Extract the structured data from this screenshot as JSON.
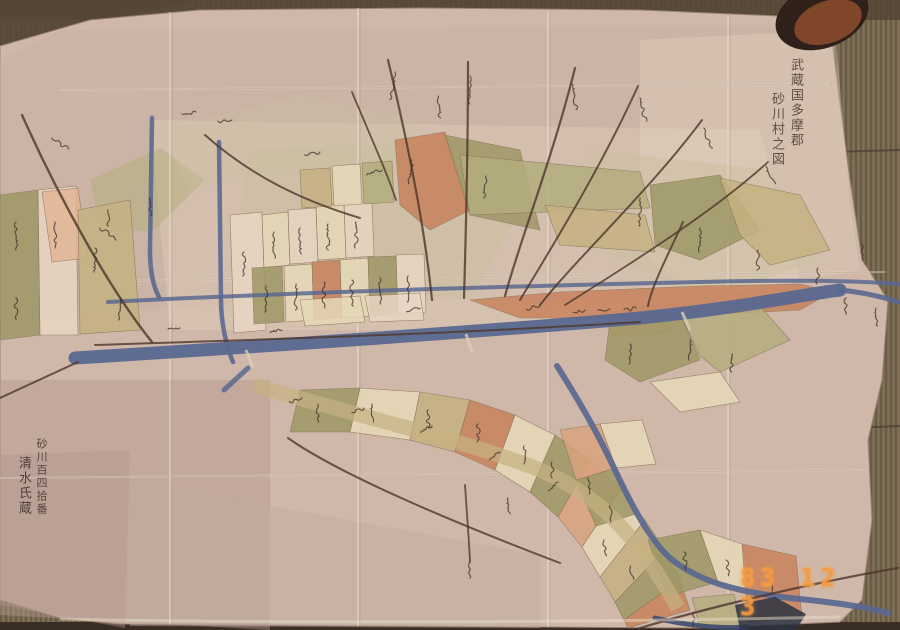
{
  "photo": {
    "date_stamp": {
      "text": "83 12 3",
      "color": "#f49b43"
    }
  },
  "map": {
    "title_columns": {
      "col1": "武蔵国多摩郡",
      "col2": "砂川村之図"
    },
    "owner_columns": {
      "col1": "砂川百四拾番",
      "col2": "清水氏蔵"
    }
  },
  "palette": {
    "paper": "#cfb8a9",
    "paperLight": "#ddc9b6",
    "paperGray": "#c2aba0",
    "paperMauve": "#b1978b",
    "tatami": "#796a51",
    "tatamiDark": "#554737",
    "olive": "#9e9866",
    "oliveLight": "#b4ae7e",
    "khaki": "#c6b282",
    "cream": "#e6d9b8",
    "creamPink": "#e9d6c4",
    "salmon": "#c8835d",
    "salmonLight": "#d9a37e",
    "peach": "#e2b595",
    "wash": "#c9c0a0",
    "river": "#5a6890",
    "riverDark": "#3e4a6e",
    "road": "#4e362b",
    "ink": "#3e302a",
    "crease": "#ece0d0",
    "weight": "#8a4a2c",
    "weightDark": "#30201a"
  },
  "geometry": {
    "paper_outline": "0,46 90,20 200,10 420,8 640,10 778,16 830,26 838,90 850,180 862,260 888,300 882,380 868,440 872,520 862,600 840,622 700,628 400,626 120,624 60,618 0,600",
    "tone_patches": [
      {
        "points": "60,30 830,26 845,150 860,270 700,300 400,300 100,310 0,320 0,60",
        "color": "paperGray",
        "op": 0.35
      },
      {
        "points": "150,120 760,130 800,280 500,330 170,330",
        "color": "paperLight",
        "op": 0.5
      },
      {
        "points": "0,380 270,380 270,630 0,615",
        "color": "paperMauve",
        "op": 0.45
      },
      {
        "points": "0,455 130,450 125,628 0,605",
        "color": "paperMauve",
        "op": 0.4
      },
      {
        "points": "130,480 540,555 540,628 130,626",
        "color": "paperGray",
        "op": 0.45
      },
      {
        "points": "640,40 835,30 850,200 860,270 700,300 640,250",
        "color": "creamPink",
        "op": 0.35
      }
    ],
    "washes": [
      {
        "points": "250,150 470,140 520,210 470,300 300,280 240,210",
        "color": "wash",
        "op": 0.55
      },
      {
        "points": "590,150 770,170 820,260 700,300 600,250",
        "color": "wash",
        "op": 0.5
      },
      {
        "points": "90,180 160,148 205,180 152,232 100,226",
        "color": "oliveLight",
        "op": 0.55
      },
      {
        "points": "160,130 300,95 420,120 400,160 250,175 190,190",
        "color": "wash",
        "op": 0.35
      }
    ],
    "parcels": [
      {
        "points": "0,195 38,190 40,335 0,340",
        "color": "olive"
      },
      {
        "points": "38,190 76,186 78,335 40,335",
        "color": "creamPink"
      },
      {
        "points": "42,192 78,188 88,258 52,262",
        "color": "peach"
      },
      {
        "points": "78,210 130,200 140,330 80,334",
        "color": "khaki"
      },
      {
        "points": "230,215 262,212 266,330 234,333",
        "color": "creamPink"
      },
      {
        "points": "262,215 288,212 290,265 264,268",
        "color": "cream"
      },
      {
        "points": "288,210 316,208 318,262 290,264",
        "color": "creamPink"
      },
      {
        "points": "316,206 344,204 346,258 318,260",
        "color": "cream"
      },
      {
        "points": "344,204 372,202 374,256 346,258",
        "color": "creamPink"
      },
      {
        "points": "252,268 282,266 284,322 254,324",
        "color": "olive"
      },
      {
        "points": "284,266 312,264 314,320 286,322",
        "color": "cream"
      },
      {
        "points": "312,262 340,260 342,318 314,320",
        "color": "salmon"
      },
      {
        "points": "340,260 368,258 370,316 342,318",
        "color": "cream"
      },
      {
        "points": "368,257 396,256 398,314 370,316",
        "color": "olive"
      },
      {
        "points": "396,255 424,254 426,312 398,314",
        "color": "creamPink"
      },
      {
        "points": "300,170 330,168 332,206 302,208",
        "color": "khaki"
      },
      {
        "points": "332,166 360,164 362,204 334,206",
        "color": "cream"
      },
      {
        "points": "362,163 392,161 394,202 364,204",
        "color": "oliveLight"
      },
      {
        "points": "395,140 445,132 470,210 430,230 400,205",
        "color": "salmon"
      },
      {
        "points": "445,135 520,150 540,230 470,215",
        "color": "olive"
      },
      {
        "points": "460,155 640,172 650,208 470,215",
        "color": "oliveLight"
      },
      {
        "points": "545,205 645,215 655,252 560,245",
        "color": "khaki"
      },
      {
        "points": "650,185 720,175 760,230 700,260 655,245",
        "color": "olive"
      },
      {
        "points": "720,178 800,195 830,250 770,265 740,235",
        "color": "khaki"
      },
      {
        "points": "470,300 560,292 700,286 800,284 832,292 800,310 640,318 520,318",
        "color": "salmon"
      },
      {
        "points": "300,300 360,296 365,322 305,326",
        "color": "cream"
      },
      {
        "points": "365,296 420,293 424,320 370,322",
        "color": "creamPink"
      },
      {
        "points": "608,318 668,314 672,332 612,336",
        "color": "salmonLight"
      },
      {
        "points": "610,320 680,314 700,360 640,382 605,360",
        "color": "olive"
      },
      {
        "points": "680,314 760,306 790,340 720,372 700,356",
        "color": "oliveLight"
      },
      {
        "points": "650,382 720,372 740,402 680,412",
        "color": "cream"
      },
      {
        "points": "300,390 360,388 350,432 290,432",
        "color": "olive"
      },
      {
        "points": "360,388 420,392 410,440 350,432",
        "color": "cream"
      },
      {
        "points": "420,392 470,400 455,452 410,440",
        "color": "khaki"
      },
      {
        "points": "470,400 515,415 495,470 455,452",
        "color": "salmon"
      },
      {
        "points": "515,415 555,435 530,492 495,470",
        "color": "cream"
      },
      {
        "points": "555,435 590,460 558,517 530,492",
        "color": "olive"
      },
      {
        "points": "590,460 620,490 582,547 558,517",
        "color": "salmonLight"
      },
      {
        "points": "620,490 645,520 600,577 582,547",
        "color": "cream"
      },
      {
        "points": "645,520 665,550 615,602 600,577",
        "color": "khaki"
      },
      {
        "points": "665,550 680,580 624,620 615,602",
        "color": "olive"
      },
      {
        "points": "680,580 690,610 628,628 624,620",
        "color": "salmon"
      },
      {
        "points": "560,430 600,424 616,468 576,480",
        "color": "salmonLight"
      },
      {
        "points": "600,424 642,420 656,464 616,468",
        "color": "cream"
      },
      {
        "points": "576,480 616,468 636,514 596,526",
        "color": "olive"
      },
      {
        "points": "648,540 700,530 718,582 668,596",
        "color": "olive"
      },
      {
        "points": "700,530 742,544 754,592 718,582",
        "color": "cream"
      },
      {
        "points": "742,544 796,556 802,618 748,622",
        "color": "salmon"
      },
      {
        "points": "692,598 734,594 742,628 700,628",
        "color": "oliveLight"
      }
    ],
    "valley_edge": {
      "d": "M255,385 C 340,412 460,438 540,470 C 600,495 640,540 678,608",
      "color": "khaki",
      "w": 15,
      "op": 0.7
    },
    "creases": [
      {
        "d": "M170,12 L170,624",
        "v": true
      },
      {
        "d": "M358,8 L358,626",
        "v": true
      },
      {
        "d": "M548,11 L548,627",
        "v": true
      },
      {
        "d": "M728,16 L728,627",
        "v": true
      },
      {
        "d": "M60,90 L830,84",
        "v": false
      },
      {
        "d": "M0,282 L885,272",
        "v": false
      },
      {
        "d": "M0,478 L868,470",
        "v": false
      }
    ],
    "rivers": [
      {
        "d": "M75,358 C 300,344 500,330 640,318 C 740,308 800,295 840,290",
        "w": 13,
        "op": 0.95,
        "color": "river"
      },
      {
        "d": "M840,290 C 860,292 880,296 898,302",
        "w": 5,
        "op": 0.9,
        "color": "river"
      },
      {
        "d": "M108,302 C 300,292 520,286 700,282 C 780,280 850,280 898,284",
        "w": 4,
        "op": 0.85,
        "color": "river"
      },
      {
        "d": "M152,118 L150,250 C 150,272 153,286 159,297",
        "w": 4.5,
        "op": 0.9,
        "color": "river"
      },
      {
        "d": "M219,142 L221,300 C 221,322 226,346 233,362",
        "w": 4.5,
        "op": 0.9,
        "color": "river"
      },
      {
        "d": "M248,368 L224,390",
        "w": 5,
        "op": 0.85,
        "color": "river"
      },
      {
        "d": "M557,366 C 580,402 601,440 615,470 C 632,506 650,540 670,558 C 700,583 740,592 790,598 C 830,602 862,606 888,613",
        "w": 6,
        "op": 0.92,
        "color": "river"
      },
      {
        "d": "M655,618 C 690,626 720,629 748,627",
        "w": 5,
        "op": 0.9,
        "color": "riverDark"
      }
    ],
    "bridges": [
      {
        "d": "M246,350 L253,368"
      },
      {
        "d": "M466,334 L472,352"
      },
      {
        "d": "M682,312 L690,330"
      }
    ],
    "roads": [
      {
        "d": "M388,60 C 412,160 426,240 432,300",
        "w": 2.2
      },
      {
        "d": "M468,62 C 468,150 466,230 464,298",
        "w": 2.2
      },
      {
        "d": "M575,68 C 552,160 520,240 505,296",
        "w": 2.2
      },
      {
        "d": "M638,86 C 600,170 550,250 520,300",
        "w": 2
      },
      {
        "d": "M702,120 C 650,190 575,260 540,305",
        "w": 2
      },
      {
        "d": "M768,162 C 710,215 620,270 565,305",
        "w": 1.8
      },
      {
        "d": "M205,135 C 250,175 300,200 360,218",
        "w": 2
      },
      {
        "d": "M22,115 C 60,200 110,290 152,342",
        "w": 2.4
      },
      {
        "d": "M95,345 C 250,340 450,334 640,322",
        "w": 2
      },
      {
        "d": "M683,222 C 668,255 652,285 648,306",
        "w": 2
      },
      {
        "d": "M78,362 L0,398",
        "w": 2
      },
      {
        "d": "M288,438 C 340,475 460,525 560,563",
        "w": 2
      },
      {
        "d": "M465,485 C 467,515 469,540 470,562",
        "w": 1.8
      },
      {
        "d": "M640,628 C 700,610 800,585 898,568",
        "w": 2.2
      },
      {
        "d": "M352,92 C 372,140 388,175 396,200",
        "w": 1.8
      }
    ],
    "marks": [
      [
        395,
        72,
        28,
        8
      ],
      [
        470,
        76,
        28,
        0
      ],
      [
        572,
        84,
        26,
        -10
      ],
      [
        640,
        98,
        24,
        -14
      ],
      [
        704,
        128,
        22,
        -20
      ],
      [
        766,
        166,
        20,
        -24
      ],
      [
        52,
        138,
        20,
        -55
      ],
      [
        100,
        228,
        20,
        -55
      ],
      [
        196,
        112,
        14,
        80
      ],
      [
        232,
        120,
        14,
        80
      ],
      [
        320,
        152,
        16,
        76
      ],
      [
        382,
        170,
        16,
        74
      ],
      [
        438,
        96,
        22,
        -4
      ],
      [
        640,
        198,
        28,
        0
      ],
      [
        700,
        228,
        24,
        0
      ],
      [
        758,
        250,
        20,
        0
      ],
      [
        818,
        268,
        16,
        0
      ],
      [
        16,
        222,
        28,
        0
      ],
      [
        55,
        222,
        26,
        0
      ],
      [
        16,
        298,
        22,
        0
      ],
      [
        95,
        248,
        24,
        0
      ],
      [
        120,
        298,
        22,
        0
      ],
      [
        274,
        232,
        26,
        0
      ],
      [
        300,
        228,
        26,
        0
      ],
      [
        328,
        224,
        26,
        0
      ],
      [
        356,
        222,
        26,
        0
      ],
      [
        266,
        286,
        26,
        0
      ],
      [
        296,
        284,
        26,
        0
      ],
      [
        324,
        282,
        26,
        0
      ],
      [
        352,
        280,
        26,
        0
      ],
      [
        380,
        278,
        26,
        0
      ],
      [
        408,
        276,
        26,
        0
      ],
      [
        244,
        252,
        24,
        0
      ],
      [
        412,
        160,
        24,
        6
      ],
      [
        486,
        176,
        22,
        4
      ],
      [
        180,
        328,
        12,
        80
      ],
      [
        282,
        330,
        12,
        80
      ],
      [
        420,
        308,
        14,
        80
      ],
      [
        540,
        306,
        14,
        80
      ],
      [
        585,
        310,
        12,
        78
      ],
      [
        610,
        309,
        12,
        78
      ],
      [
        636,
        308,
        12,
        78
      ],
      [
        846,
        298,
        16,
        0
      ],
      [
        876,
        308,
        18,
        0
      ],
      [
        862,
        244,
        16,
        0
      ],
      [
        630,
        344,
        20,
        0
      ],
      [
        690,
        340,
        20,
        0
      ],
      [
        732,
        354,
        18,
        0
      ],
      [
        318,
        404,
        18,
        0
      ],
      [
        372,
        404,
        18,
        0
      ],
      [
        428,
        410,
        18,
        0
      ],
      [
        478,
        424,
        18,
        0
      ],
      [
        524,
        446,
        18,
        -6
      ],
      [
        302,
        398,
        13,
        68
      ],
      [
        364,
        408,
        13,
        66
      ],
      [
        432,
        426,
        13,
        62
      ],
      [
        500,
        452,
        13,
        58
      ],
      [
        558,
        482,
        13,
        52
      ],
      [
        588,
        478,
        16,
        -6
      ],
      [
        610,
        506,
        16,
        -8
      ],
      [
        552,
        462,
        16,
        -4
      ],
      [
        604,
        540,
        16,
        -8
      ],
      [
        630,
        566,
        14,
        -10
      ],
      [
        684,
        552,
        18,
        -6
      ],
      [
        726,
        560,
        16,
        -10
      ],
      [
        770,
        578,
        16,
        -12
      ],
      [
        694,
        612,
        14,
        0
      ],
      [
        470,
        562,
        16,
        0
      ],
      [
        508,
        498,
        16,
        -4
      ],
      [
        150,
        198,
        18,
        0
      ],
      [
        108,
        210,
        16,
        0
      ]
    ],
    "right_seams": [
      {
        "d": "M832,152 L900,150"
      },
      {
        "d": "M848,428 L900,426"
      }
    ]
  }
}
